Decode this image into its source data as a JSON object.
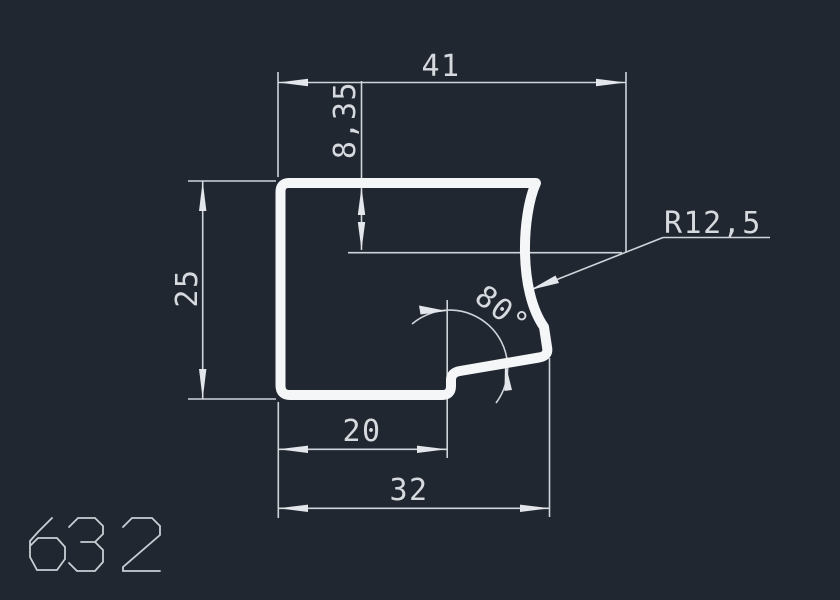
{
  "app": {
    "type": "cad-drawing-viewport",
    "background_color": "#212730",
    "profile_color": "#f4f6f8",
    "dimension_color": "#cfd4da"
  },
  "drawing": {
    "part_number": "632",
    "dimensions": {
      "overall_width": "41",
      "recess_depth": "8,35",
      "height": "25",
      "notch_width": "20",
      "bottom_width": "32",
      "fillet_radius": "R12,5",
      "angle": "80°"
    }
  }
}
